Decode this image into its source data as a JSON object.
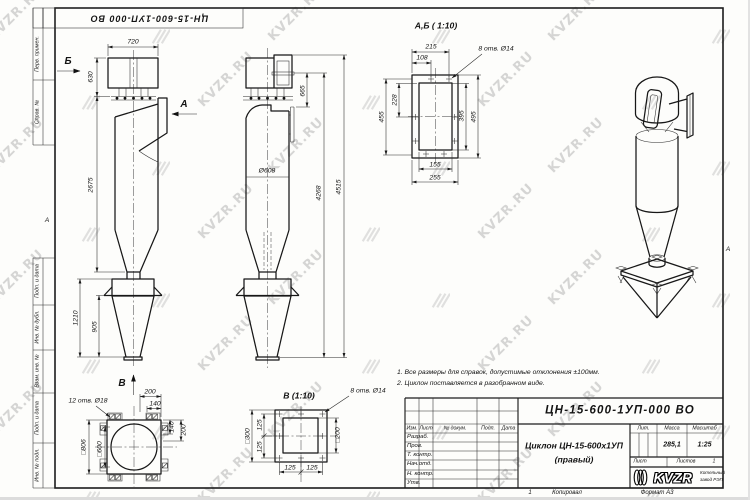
{
  "watermark": {
    "text": "KVZR.RU"
  },
  "stamp_top": {
    "doc_number": "ЦН-15-600-1УП-000 ВО"
  },
  "margins": {
    "labels": [
      "Перв. примен.",
      "Справ. №",
      "Подп. и дата",
      "Инв. № дубл.",
      "Взам. инв. №",
      "Подп. и дата",
      "Инв. № подл."
    ],
    "fold_mark": "А"
  },
  "notes": {
    "line1": "1. Все размеры для справок, допустимые отклонения ±100мм.",
    "line2": "2. Циклон поставляется в разобранном виде."
  },
  "views": {
    "front": {
      "dim_width_top": "720",
      "dim_inlet_box": "630",
      "dim_body": "2675",
      "dim_bunker": "1210",
      "dim_hopper": "905",
      "view_arrow_b": "Б",
      "view_arrow_a": "А",
      "view_arrow_v": "В"
    },
    "side": {
      "dim_outlet_to_inlet": "665",
      "dim_diameter": "Ø608",
      "dim_to_inlet_total": "4268",
      "dim_total_height": "4515"
    },
    "support": {
      "holes_note": "12 отв. Ø18",
      "dim_200_top": "200",
      "dim_140_top": "140",
      "dim_140_right": "140",
      "dim_200_right": "200",
      "dim_outer_square": "□806",
      "dim_inner_square": "□600"
    },
    "section_ab": {
      "title": "А,Б ( 1:10)",
      "holes_note": "8 отв. Ø14",
      "dim_215": "215",
      "dim_108": "108",
      "dim_228": "228",
      "dim_455": "455",
      "dim_395": "395",
      "dim_495": "495",
      "dim_155": "155",
      "dim_255": "255"
    },
    "section_v": {
      "title": "В (1:10)",
      "holes_note": "8 отв. Ø14",
      "dim_outer": "□300",
      "dim_inner": "□200",
      "dim_pitch_left_1": "125",
      "dim_pitch_left_2": "125",
      "dim_pitch_bottom_1": "125",
      "dim_pitch_bottom_2": "125"
    }
  },
  "title_block": {
    "doc_number": "ЦН-15-600-1УП-000 ВО",
    "name_line1": "Циклон ЦН-15-600х1УП",
    "name_line2": "(правый)",
    "header_cols": [
      "Изм.",
      "Лист",
      "№ докум.",
      "Подп.",
      "Дата"
    ],
    "sign_rows": [
      "Разраб.",
      "Пров.",
      "Т. контр.",
      "Нач.отд.",
      "Н. контр.",
      "Утв."
    ],
    "lit_label": "Лит.",
    "mass_label": "Масса",
    "scale_label": "Масштаб",
    "mass_value": "285,1",
    "scale_value": "1:25",
    "sheet_label": "Лист",
    "sheets_label": "Листов",
    "sheets_value": "1",
    "logo_text": "KVZR",
    "logo_caption_line1": "Котельный",
    "logo_caption_line2": "завод РЭП",
    "footer_page": "1",
    "footer_copy": "Копировал",
    "footer_format": "Формат А3"
  }
}
